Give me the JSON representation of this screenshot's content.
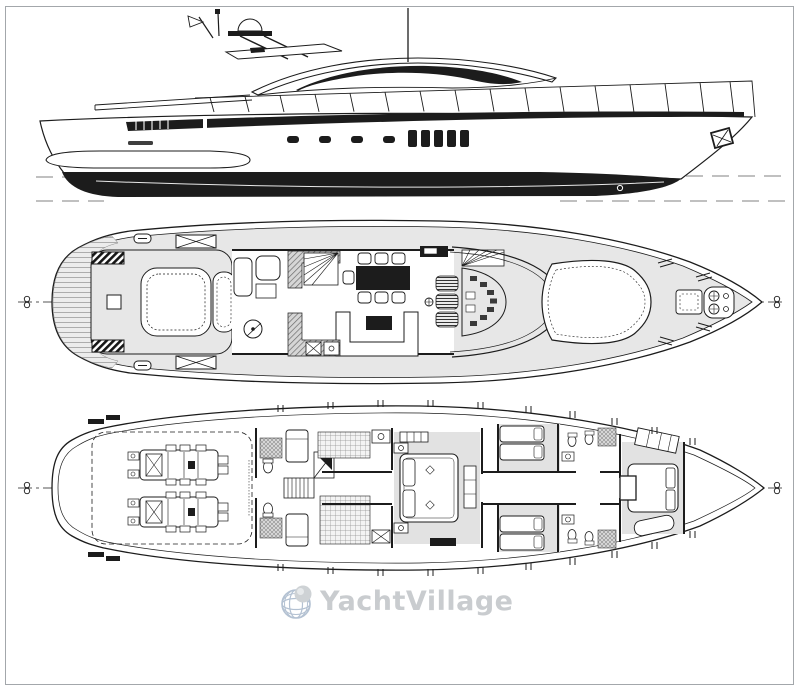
{
  "document": {
    "views": [
      "side-profile",
      "main-deck-plan",
      "lower-deck-plan"
    ]
  },
  "watermark": {
    "text": "YachtVillage"
  },
  "theme": {
    "ink": "#1c1c1c",
    "paper": "#ffffff",
    "frame": "#a3a7ab",
    "deck-shade": "#e7e7e7",
    "cabin-shade": "#e2e2e2",
    "waterline": "#b8b8b8",
    "centerline": "#555555",
    "wm-text": "#c9cccf",
    "wm-globe": "#b3c1d2",
    "wm-sphere": "#ced2d5",
    "wm-sphere-highlight": "#e6e9eb"
  }
}
